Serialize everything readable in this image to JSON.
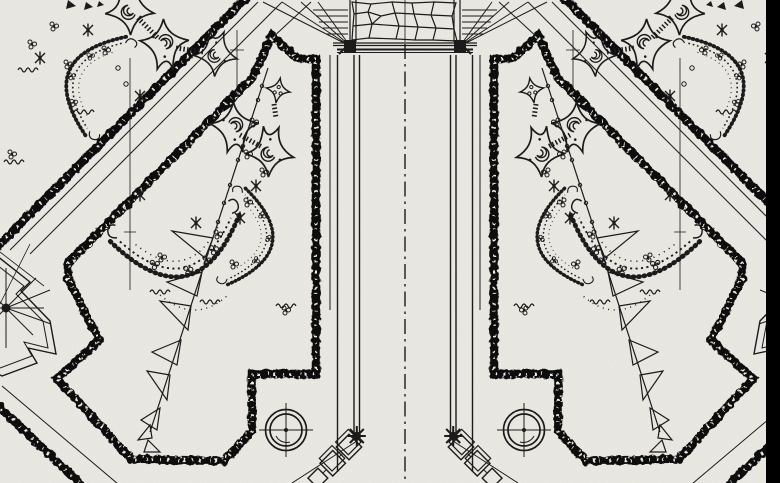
{
  "document": {
    "kind": "scanned black-and-white garden parterre plan drawing",
    "visible_text": "none",
    "symmetry": "bilateral mirror about vertical central axis",
    "center_axis_x": 405
  },
  "palette": {
    "paper": "#edebe5",
    "ink": "#1b1b1b",
    "band": "#0a0a0a",
    "edge_strip": "#000000",
    "noise": "#6b695f"
  },
  "plan": {
    "motifs": [
      {
        "name": "central-walk-with-dash-dot-axis",
        "count": 1
      },
      {
        "name": "crazy-paving-landing",
        "count": 1
      },
      {
        "name": "fanned-step-rays",
        "count": 2
      },
      {
        "name": "stippled-bed-border-band",
        "count": 6
      },
      {
        "name": "chamfered-stepped-bed",
        "count": 2
      },
      {
        "name": "corner-bed",
        "count": 2
      },
      {
        "name": "cusped-gothic-leaf-ornament",
        "count": 12
      },
      {
        "name": "feathered-crescent-shrub",
        "count": 6
      },
      {
        "name": "berry-cluster",
        "count": 24
      },
      {
        "name": "asterisk-flower",
        "count": 10
      },
      {
        "name": "zigzag-planting-line",
        "count": 2
      },
      {
        "name": "surveyors-target-circle",
        "count": 2
      },
      {
        "name": "path-end-star-node",
        "count": 2
      },
      {
        "name": "diamond-stone-chain",
        "count": 2
      },
      {
        "name": "compass-star-ornament",
        "count": 2
      },
      {
        "name": "scan-edge-strip",
        "count": 1
      }
    ]
  }
}
